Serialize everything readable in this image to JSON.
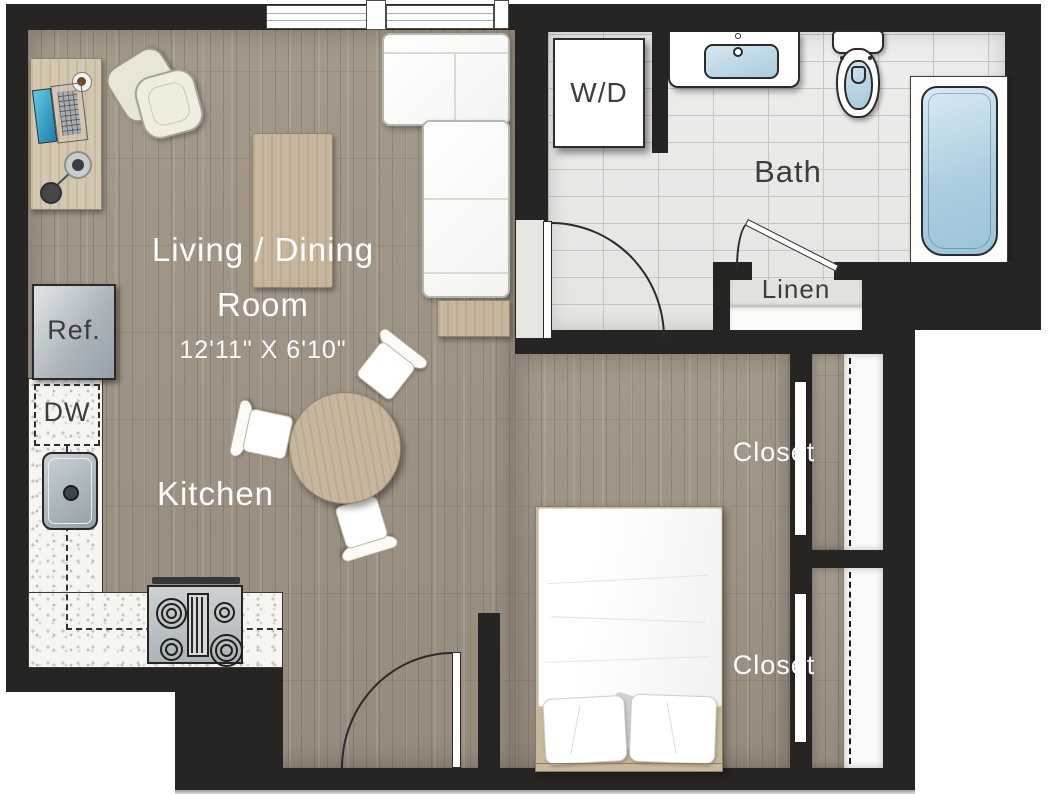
{
  "plan": {
    "type": "studio-apartment-floor-plan",
    "rooms": {
      "living_dining": {
        "label_line1": "Living / Dining",
        "label_line2": "Room",
        "dimensions": "12'11\" X 6'10\""
      },
      "kitchen": {
        "label": "Kitchen"
      },
      "bath": {
        "label": "Bath"
      },
      "linen": {
        "label": "Linen"
      },
      "closet_upper": {
        "label": "Closet"
      },
      "closet_lower": {
        "label": "Closet"
      }
    },
    "fixtures": {
      "washer_dryer": {
        "label": "W/D"
      },
      "refrigerator": {
        "label": "Ref."
      },
      "dishwasher": {
        "label": "DW"
      }
    },
    "colors": {
      "wall": "#272424",
      "wood_floor": "#a0958a",
      "tile_floor": "#ecebe8",
      "counter": "#f6f5f2",
      "furniture_tan": "#c6b69d",
      "fixture_blue": "#b4d4e6",
      "label_light": "#ffffff",
      "label_dark": "#3d3d3f"
    }
  }
}
